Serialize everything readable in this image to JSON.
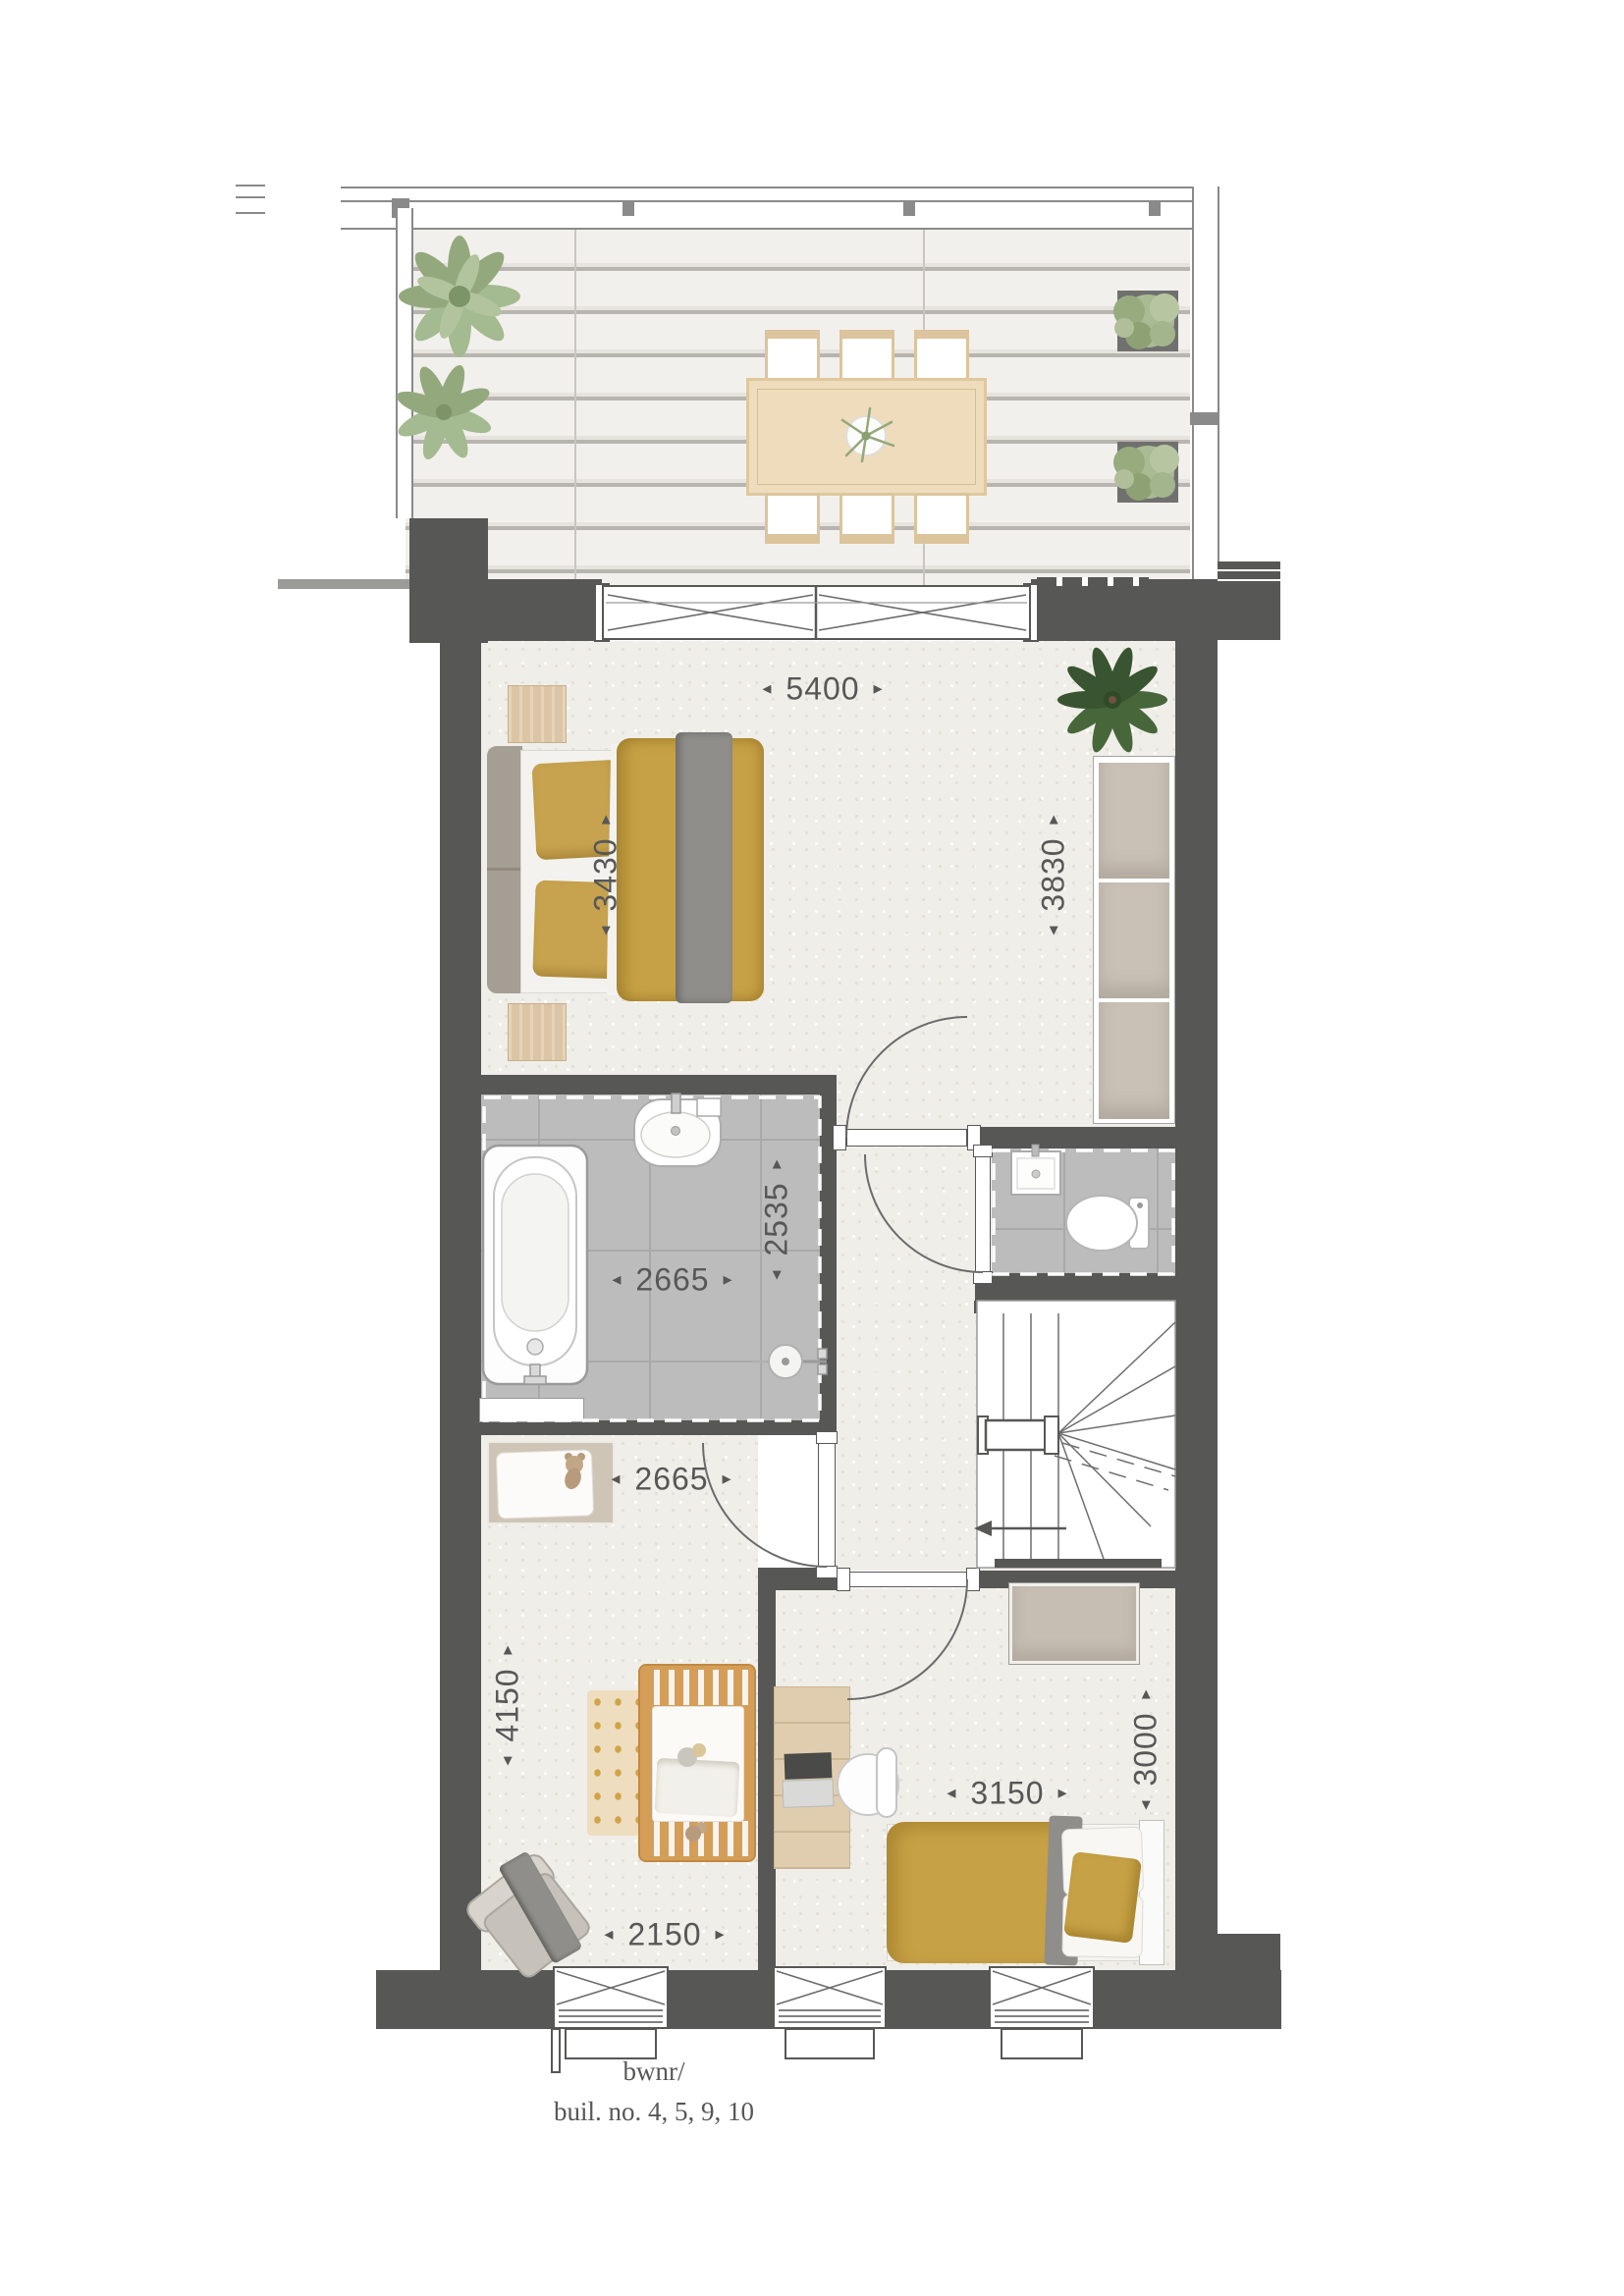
{
  "caption": {
    "line1": "bwnr/",
    "line2": "buil. no. 4, 5, 9, 10"
  },
  "dimensions": {
    "bedroom1_width": "5400",
    "bedroom1_left_depth": "3430",
    "bedroom1_right_depth": "3830",
    "bathroom_width": "2665",
    "bathroom_depth": "2535",
    "nursery_top_width": "2665",
    "nursery_depth": "4150",
    "nursery_bottom_width": "2150",
    "bedroom2_width": "3150",
    "bedroom2_depth": "3000"
  },
  "symbols": {
    "arrow_left": "◄",
    "arrow_right": "►",
    "arrow_up": "▲",
    "arrow_down": "▼"
  },
  "colors": {
    "wall": "#575756",
    "carpet": "#f0eee9",
    "tile": "#bcbcbc",
    "deck_plank": "#f2f0ec",
    "wood": "#dcc5a5",
    "mustard": "#c7a145",
    "throw_gray": "#8f8e8a",
    "leaf_green": "#9fb286",
    "text": "#575756"
  }
}
